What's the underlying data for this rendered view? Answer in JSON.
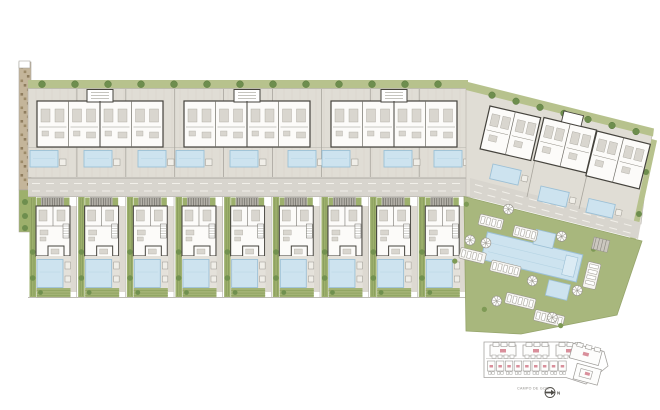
{
  "document": {
    "type": "architectural-site-plan",
    "description_visible_content": "Master plan drawing of a residential development with an upper apartment row, access road, villa row with private pools, a rotated block at right, communal pool garden, and a small key plan inset"
  },
  "colors": {
    "background": "#ffffff",
    "paving": "#e0ddd5",
    "paving_line": "#d5d2ca",
    "road": "#d8d5ce",
    "road_dash": "#f2f0ea",
    "wall": "#45433d",
    "building": "#fcfbf9",
    "pool": "#cde3ef",
    "pool_edge": "#9cc0d6",
    "pool_light": "#dbebf4",
    "lawn": "#a8b77d",
    "lawn_stripe": "#8da25e",
    "garden": "#9db06c",
    "garden_stripe": "#85995a",
    "hedge": "#b7c28d",
    "tree": "#6e8e4e",
    "tree_dark": "#5a7a3e",
    "earth": "#c4b59a",
    "earth_dark": "#9c8a68",
    "pergola": "#b4b1a9",
    "pergola_stripe": "#6f6d66",
    "furniture": "#d9d6cf",
    "furniture_edge": "#a7a49c",
    "line_faint": "#c3c0b8",
    "divider": "#a9a69e",
    "deck": "#f0eee8",
    "pad": "#f6f5f1",
    "pad_edge": "#9a978f",
    "inset_line": "#9c9a96",
    "inset_pink": "#d98f9b",
    "inset_dark": "#504e49"
  },
  "site": {
    "top_row": {
      "block_count": 3,
      "units_per_block": 4,
      "pool_count": 9,
      "hedge_tree_count": 13
    },
    "right_block": {
      "unit_count": 3,
      "pool_count": 3,
      "hedge_tree_count": 7
    },
    "villa_row": {
      "villa_count": 9
    },
    "communal": {
      "parasol_count": 8,
      "lounger_group_count": 7
    }
  },
  "inset": {
    "caption": "CAMPO DE GOLF",
    "north_label": "N"
  }
}
